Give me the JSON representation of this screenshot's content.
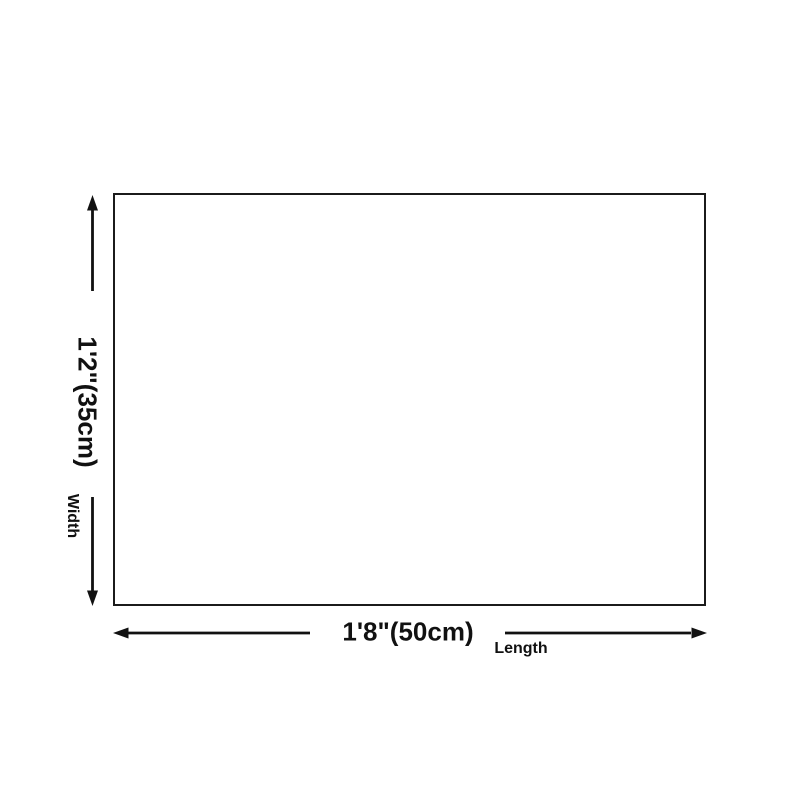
{
  "diagram": {
    "width_dimension": {
      "value": "1'2\"(35cm)",
      "label": "Width"
    },
    "length_dimension": {
      "value": "1'8\"(50cm)",
      "label": "Length"
    },
    "colors": {
      "line": "#111111",
      "outline": "#1b1b1b",
      "background": "#ffffff"
    }
  }
}
